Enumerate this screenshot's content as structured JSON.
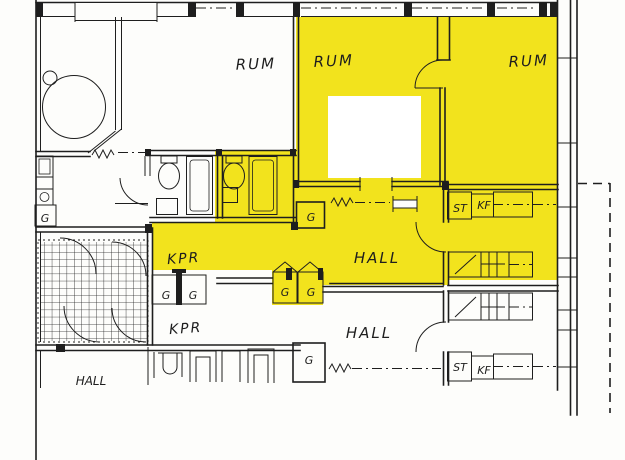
{
  "colors": {
    "highlight": "#f2e31d",
    "line": "#1e1e1e",
    "paper": "#fdfdfb",
    "patch": "#ffffff"
  },
  "labels": {
    "room_left": "RUM",
    "room_middle": "RUM",
    "room_right": "RUM",
    "kpr_upper": "KPR",
    "hall_upper": "HALL",
    "kpr_lower": "KPR",
    "hall_lower": "HALL",
    "hall_bottom_left": "HALL",
    "g_kitchen": "G",
    "g_hall_upper": "G",
    "g_yellow_left": "G",
    "g_yellow_right": "G",
    "g_white_left": "G",
    "g_white_right": "G",
    "g_lower_right": "G",
    "st_upper": "ST",
    "kf_upper": "KF",
    "st_lower": "ST",
    "kf_lower": "KF"
  }
}
